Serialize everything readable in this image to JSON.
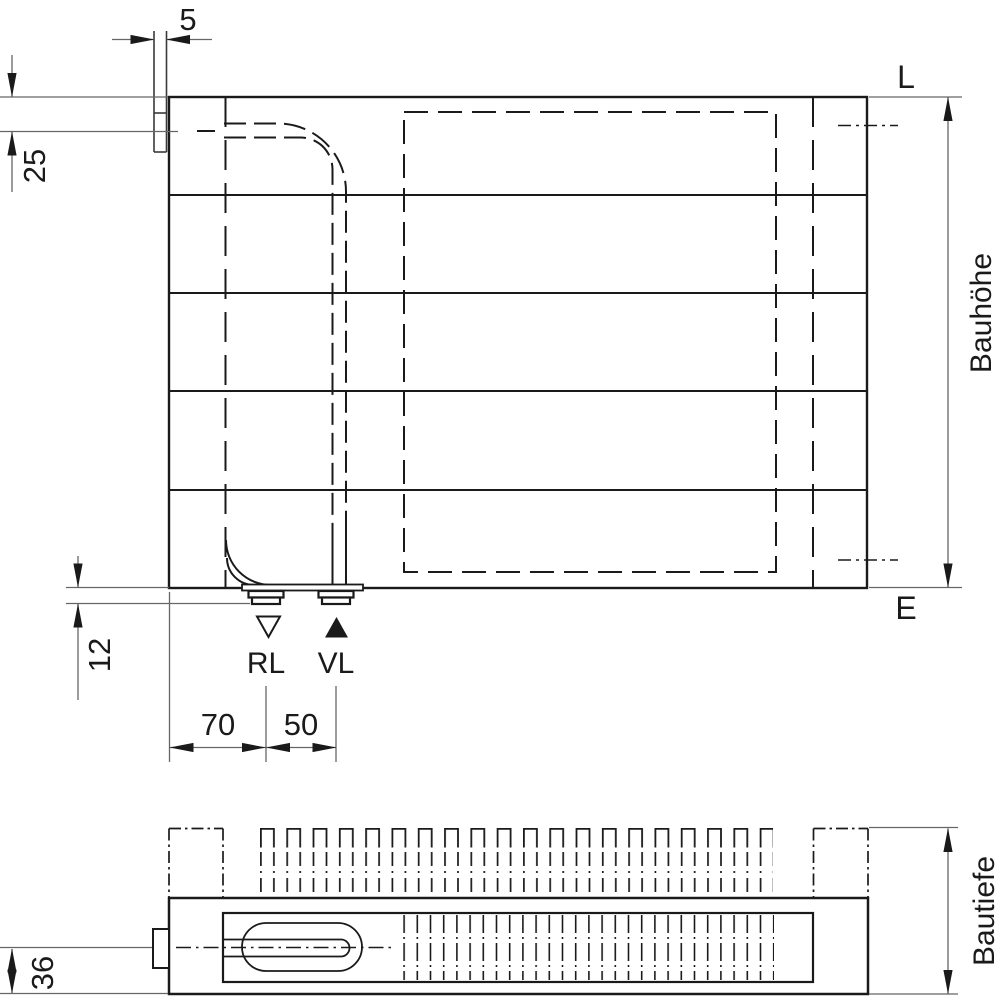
{
  "drawing_labels": {
    "front": {
      "tab_width": "5",
      "top_offset": "25",
      "stub_drop": "12",
      "edge_to_rl": "70",
      "rl_to_vl": "50",
      "return": "RL",
      "supply": "VL",
      "top_level": "L",
      "bottom_level": "E",
      "height": "Bauhöhe"
    },
    "plan": {
      "center_offset": "36",
      "depth": "Bautiefe"
    }
  },
  "colors": {
    "line": "#1a1a1a",
    "dim_line": "#666666",
    "background": "#ffffff"
  }
}
